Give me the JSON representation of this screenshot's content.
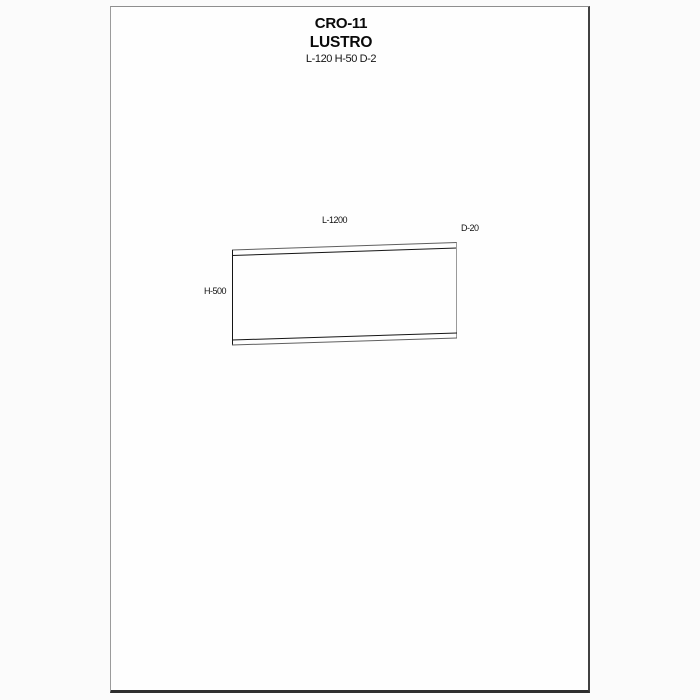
{
  "header": {
    "model": "CRO-11",
    "product": "LUSTRO",
    "dimensions": "L-120 H-50 D-2"
  },
  "drawing": {
    "labels": {
      "length": "L-1200",
      "depth": "D-20",
      "height": "H-500"
    },
    "colors": {
      "edge_dark": "#151515",
      "edge_medium": "#5f5f5f",
      "edge_light": "#9a9a9a"
    }
  },
  "page": {
    "border_light_color": "#8e8e8e",
    "border_dark_color": "#2d2d2d",
    "background_color": "#fefefe"
  }
}
